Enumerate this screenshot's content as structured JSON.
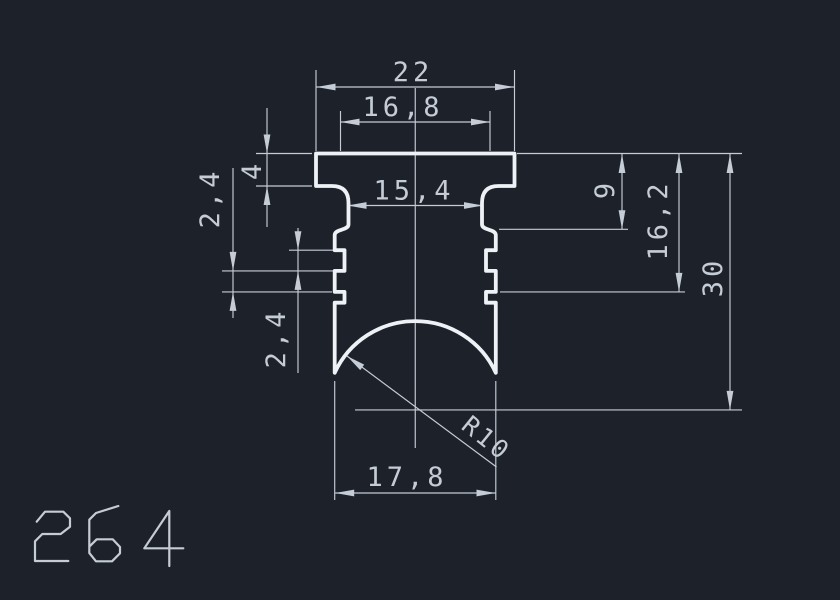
{
  "drawing": {
    "part_number": "264",
    "labels": {
      "overall_width": "22",
      "top_flange_width": "16,8",
      "neck_width": "15,4",
      "flange_thickness": "4",
      "groove_step_upper": "2,4",
      "groove_step_lower": "2,4",
      "shoulder_height": "9",
      "groove_height": "16,2",
      "overall_height": "30",
      "bottom_width": "17,8",
      "radius": "R10"
    },
    "colors": {
      "background": "#1d222a",
      "profile_line": "#eef1f5",
      "dimension_line": "#c6ccd6"
    }
  }
}
